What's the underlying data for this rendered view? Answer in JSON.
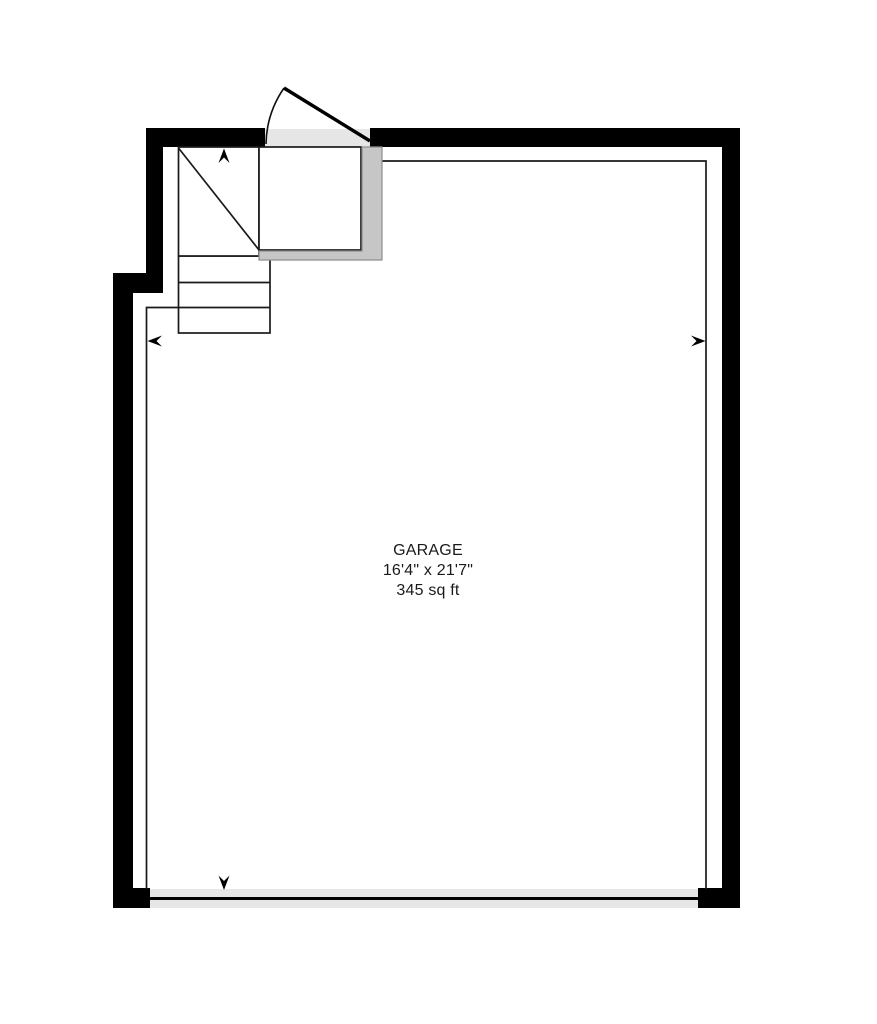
{
  "room_label": {
    "name": "GARAGE",
    "dimensions": "16'4\" x 21'7\"",
    "area": "345 sq ft"
  },
  "colors": {
    "wall": "#000000",
    "line": "#1a1a1a",
    "light_gray": "#e6e6e6",
    "guard_fill": "#c6c6c6",
    "guard_outline": "#8e8e8e",
    "text": "#1a1a1a",
    "background": "#ffffff"
  },
  "plan_symbols": {
    "entry_door": {
      "type": "swing door",
      "wall": "top",
      "swing": "outward, hinged right"
    },
    "garage_door": {
      "type": "overhead garage door",
      "wall": "bottom"
    },
    "stairs": {
      "treads": 3,
      "winder_diagonal": true,
      "landing": true,
      "direction": "up"
    },
    "arrows": [
      {
        "direction": "up",
        "location": "top of stairs"
      },
      {
        "direction": "left",
        "location": "left interior wall"
      },
      {
        "direction": "right",
        "location": "right interior wall"
      },
      {
        "direction": "down",
        "location": "garage door opening"
      }
    ]
  }
}
